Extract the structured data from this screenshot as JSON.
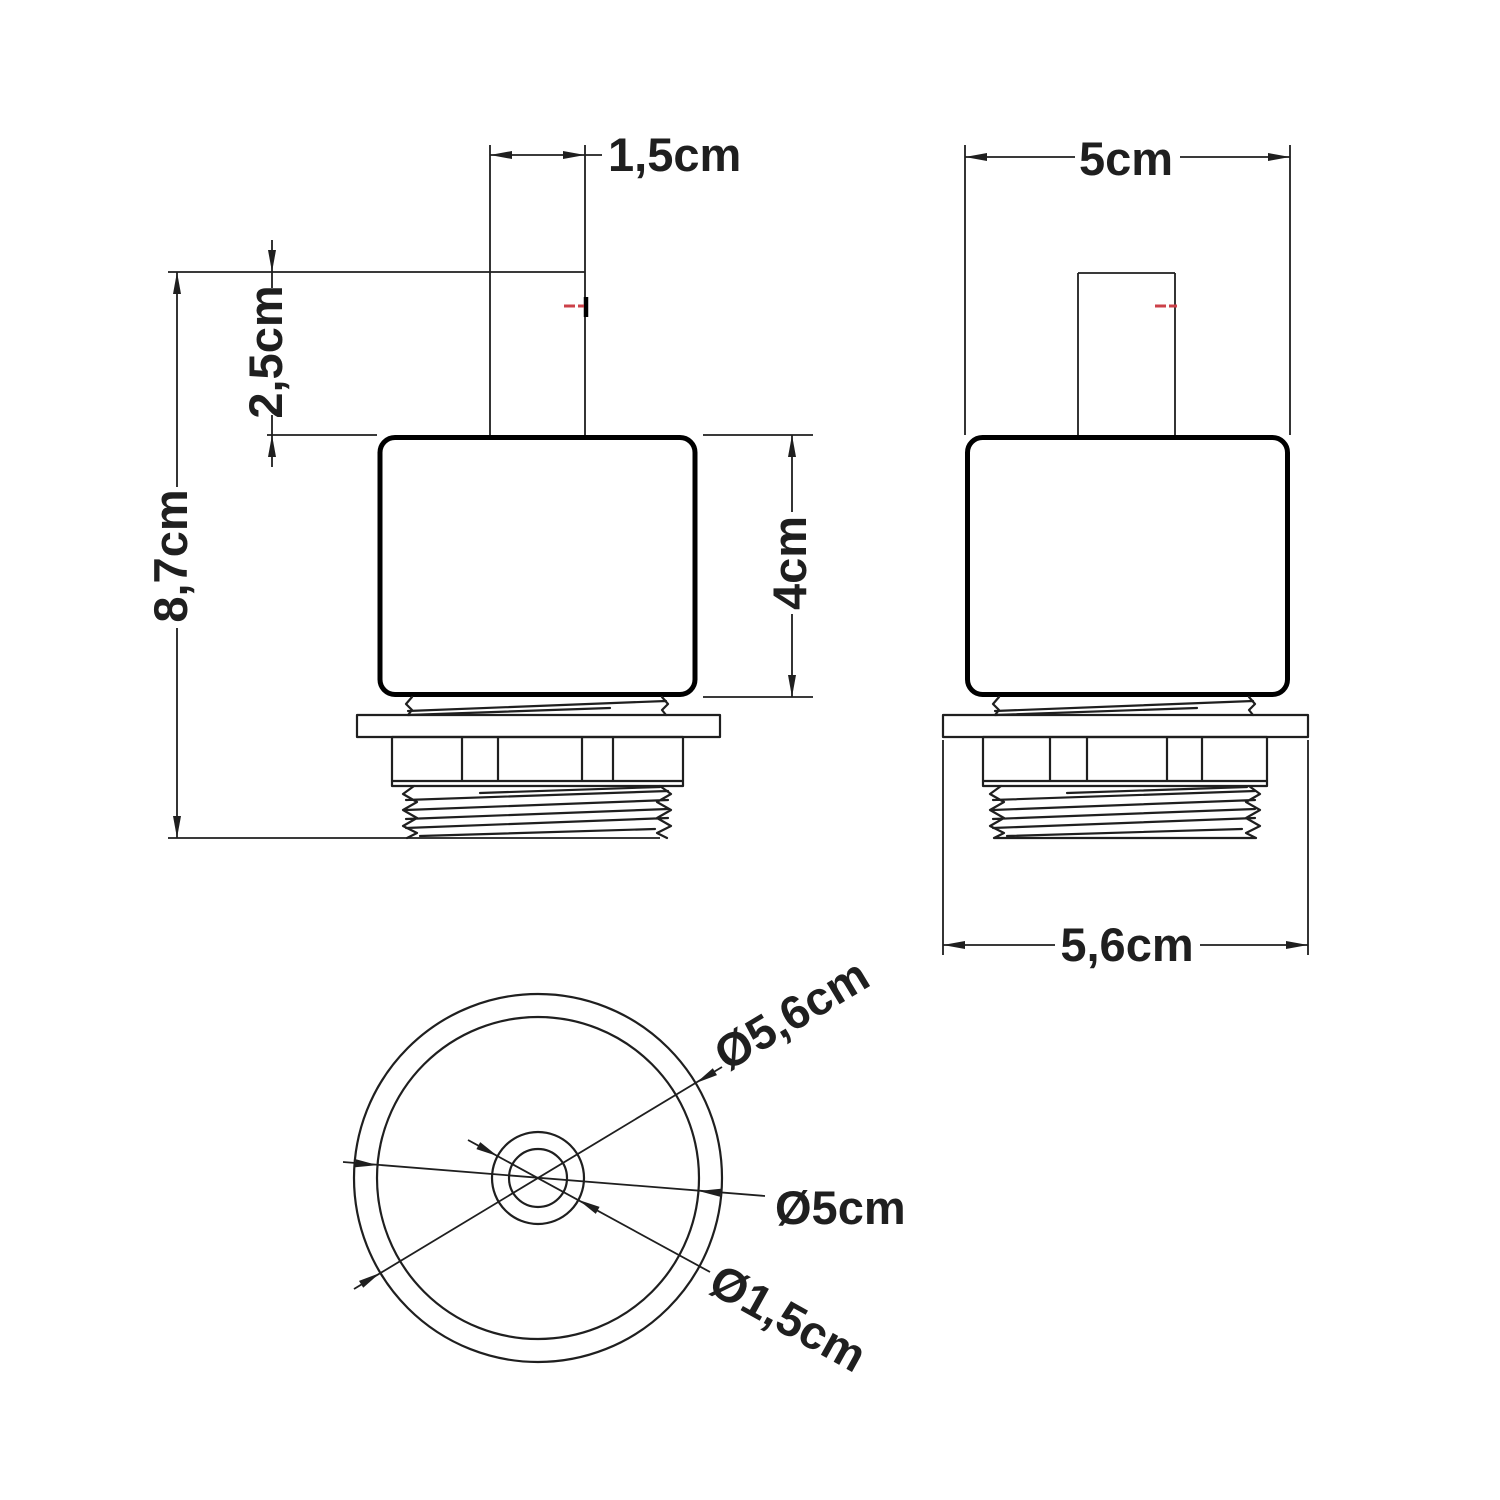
{
  "views": {
    "front": {
      "dims": {
        "stem_width": "1,5cm",
        "stem_height": "2,5cm",
        "total_height": "8,7cm",
        "body_height": "4cm"
      }
    },
    "side": {
      "dims": {
        "body_width": "5cm",
        "flange_width": "5,6cm"
      }
    },
    "top": {
      "dims": {
        "flange_diameter": "Ø5,6cm",
        "body_diameter": "Ø5cm",
        "stem_diameter": "Ø1,5cm"
      }
    }
  },
  "colors": {
    "line": "#1f1f1f",
    "bold_line": "#000000",
    "red_mark": "#cc4149",
    "background": "#ffffff"
  }
}
